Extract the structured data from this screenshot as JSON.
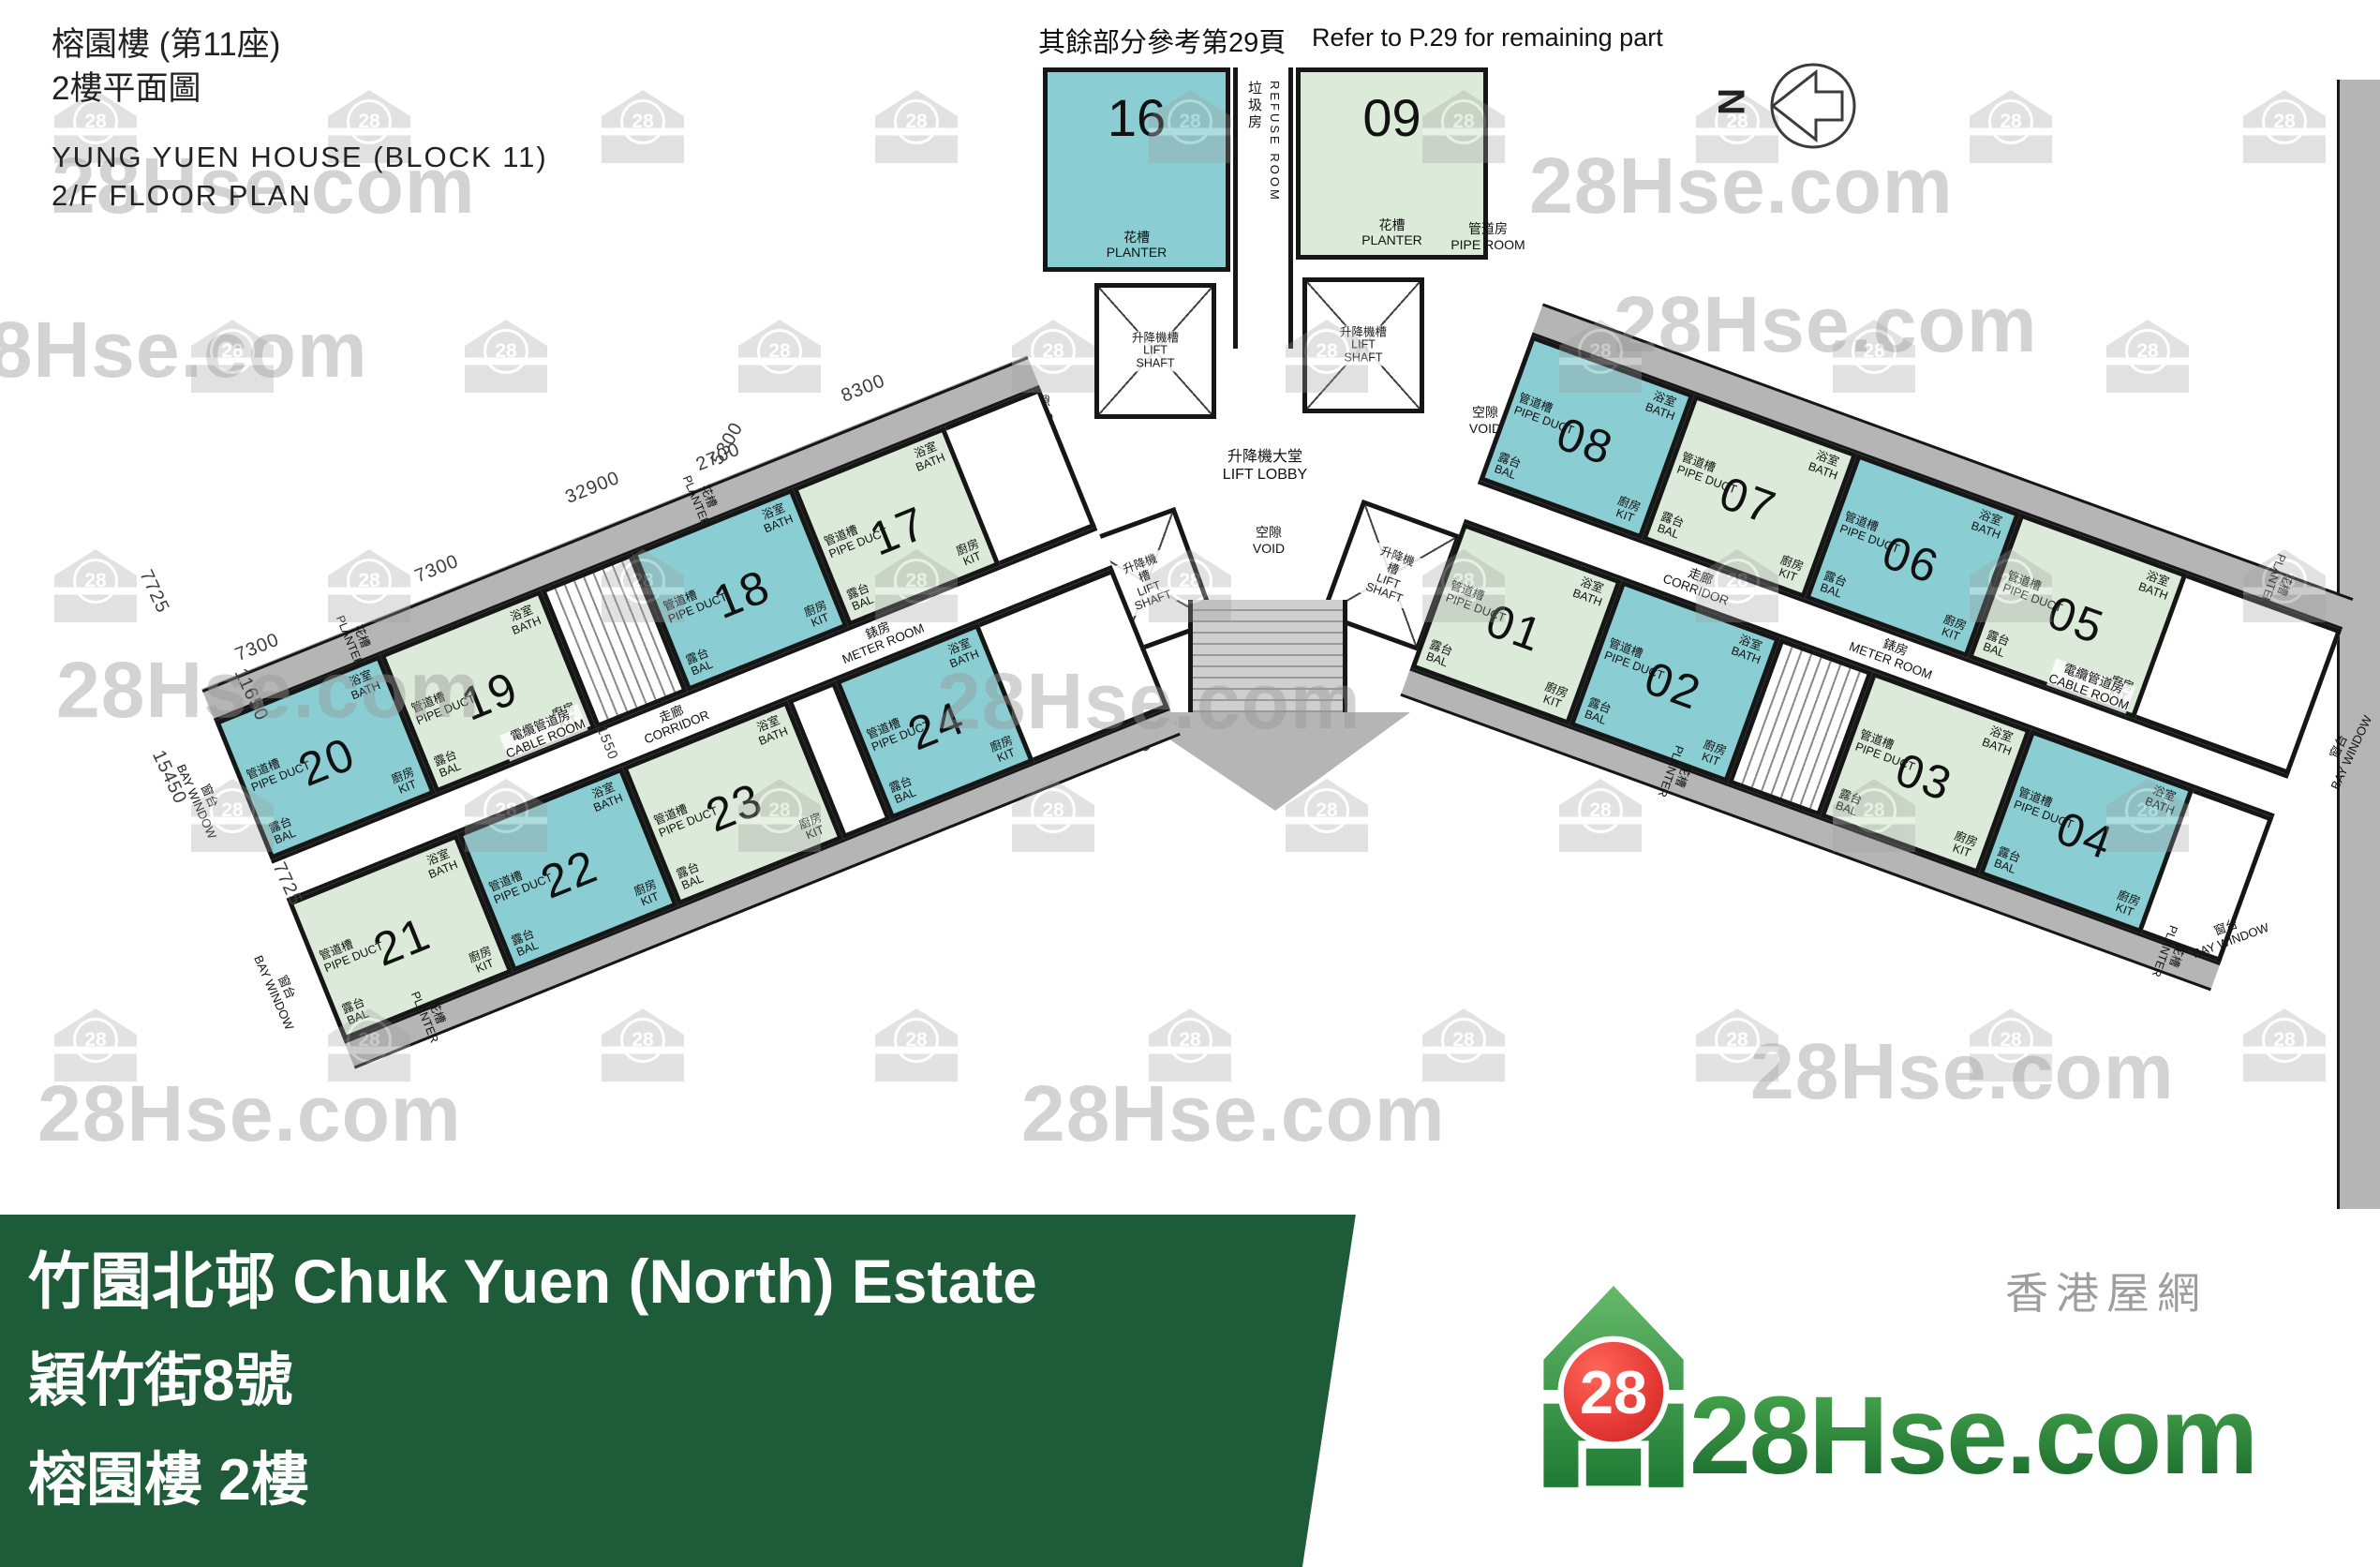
{
  "header": {
    "title_zh1": "榕園樓 (第11座)",
    "title_zh2": "2樓平面圖",
    "title_en1": "YUNG YUEN HOUSE (BLOCK 11)",
    "title_en2": "2/F FLOOR PLAN"
  },
  "note": {
    "zh": "其餘部分參考第29頁",
    "en": "Refer to P.29 for remaining part"
  },
  "compass": {
    "label": "N"
  },
  "watermark": {
    "text": "28Hse.com",
    "badge": "28"
  },
  "rooms": {
    "bath_zh": "浴室",
    "bath_en": "BATH",
    "bal_zh": "露台",
    "bal_en": "BAL",
    "kit_zh": "廚房",
    "kit_en": "KIT",
    "pipe_duct_zh": "管道槽",
    "pipe_duct_en": "PIPE DUCT",
    "planter_zh": "花槽",
    "planter_en": "PLANTER",
    "corridor_zh": "走廊",
    "corridor_en": "CORRIDOR",
    "meter_zh": "錶房",
    "meter_en": "METER ROOM",
    "cable_zh": "電纜管道房",
    "cable_en": "CABLE ROOM",
    "lobby_zh": "升降機大堂",
    "lobby_en": "LIFT LOBBY",
    "shaft_zh": "升降機槽",
    "shaft_en": "LIFT SHAFT",
    "refuse_zh": "垃圾房",
    "refuse_en": "REFUSE ROOM",
    "pipe_room_zh": "管道房",
    "pipe_room_en": "PIPE ROOM",
    "void_zh": "空隙",
    "void_en": "VOID",
    "bay_zh": "窗台",
    "bay_en": "BAY WINDOW"
  },
  "core": {
    "units": [
      {
        "number": "16",
        "tone": "teal"
      },
      {
        "number": "09",
        "tone": "green"
      }
    ]
  },
  "plan": {
    "left_top": [
      {
        "type": "unit",
        "number": "20",
        "tone": "teal",
        "w": 190
      },
      {
        "type": "unit",
        "number": "19",
        "tone": "green",
        "w": 185
      },
      {
        "type": "stairs",
        "w": 105
      },
      {
        "type": "unit",
        "number": "18",
        "tone": "teal",
        "w": 185
      },
      {
        "type": "unit",
        "number": "17",
        "tone": "green",
        "w": 175
      }
    ],
    "left_bottom": [
      {
        "type": "unit",
        "number": "21",
        "tone": "green",
        "w": 195
      },
      {
        "type": "unit",
        "number": "22",
        "tone": "teal",
        "w": 190
      },
      {
        "type": "unit",
        "number": "23",
        "tone": "green",
        "w": 190
      },
      {
        "type": "gap",
        "w": 55
      },
      {
        "type": "unit",
        "number": "24",
        "tone": "teal",
        "w": 165
      }
    ],
    "right_top": [
      {
        "type": "unit",
        "number": "08",
        "tone": "teal",
        "w": 185
      },
      {
        "type": "unit",
        "number": "07",
        "tone": "green",
        "w": 185
      },
      {
        "type": "unit",
        "number": "06",
        "tone": "teal",
        "w": 185
      },
      {
        "type": "unit",
        "number": "05",
        "tone": "green",
        "w": 190
      }
    ],
    "right_bottom": [
      {
        "type": "unit",
        "number": "01",
        "tone": "green",
        "w": 180
      },
      {
        "type": "unit",
        "number": "02",
        "tone": "teal",
        "w": 180
      },
      {
        "type": "stairs",
        "w": 105
      },
      {
        "type": "unit",
        "number": "03",
        "tone": "green",
        "w": 180
      },
      {
        "type": "unit",
        "number": "04",
        "tone": "teal",
        "w": 185
      }
    ]
  },
  "dims": {
    "top": [
      "7300",
      "7300",
      "32900",
      "2700",
      "8300"
    ],
    "left": [
      "7725",
      "11650",
      "15450",
      "7725"
    ],
    "misc": [
      "1550",
      "5300",
      "5800"
    ]
  },
  "footer": {
    "line1": "竹園北邨 Chuk Yuen (North) Estate",
    "line2": "穎竹街8號",
    "line3": "榕園樓 2樓",
    "logo_cn": "香港屋網",
    "logo_text": "28Hse.com",
    "logo_badge": "28"
  }
}
